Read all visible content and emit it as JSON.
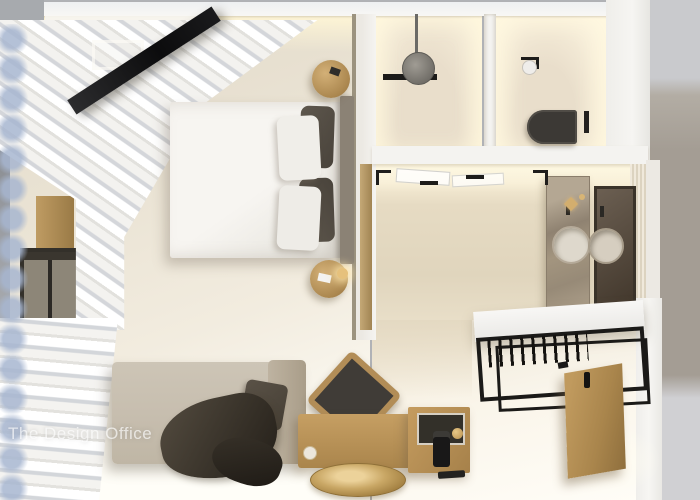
{
  "watermark": {
    "text": "The Design Office"
  },
  "palette": {
    "backdrop_gray": "#b0b2b6",
    "backdrop_warm": "#a49d94",
    "backdrop_light": "#d0d0d3",
    "wall_white": "#f4f3f0",
    "floor_cream": "#ece5d8",
    "floor_tile": "#e4d9c2",
    "glow_warm": "#fff6da",
    "wood": "#b8935a",
    "wood_deep": "#9a7a46",
    "charcoal": "#1b1a18",
    "taupe_dark": "#534c42",
    "sofa": "#c7beaf",
    "duvet": "#f7f5f1",
    "curtain_blue": "#a7b6d0",
    "gold": "#d3ae6e",
    "marble": "#a3957f",
    "mirror": "#57493a",
    "headboard": "#8b8275"
  },
  "scene": {
    "view": "top-down 3d interior render",
    "objects": [
      "tv-panel",
      "double-bed",
      "dark-cushions",
      "white-pillows",
      "round-nightstands",
      "table-lamp",
      "sheer-curtains",
      "window",
      "wood-cabinet",
      "sofa-daybed",
      "throw-blanket",
      "accent-chair",
      "wooden-console",
      "minibar-cube",
      "coffee-machine",
      "round-brass-table",
      "rain-shower-head",
      "shower-niche",
      "wall-hung-toilet",
      "flush-plate",
      "toilet-paper-holder",
      "marble-vanity",
      "double-basins",
      "vanity-mirror",
      "glass-door-hardware",
      "open-wardrobe-rack",
      "hangers",
      "entrance-door"
    ]
  }
}
